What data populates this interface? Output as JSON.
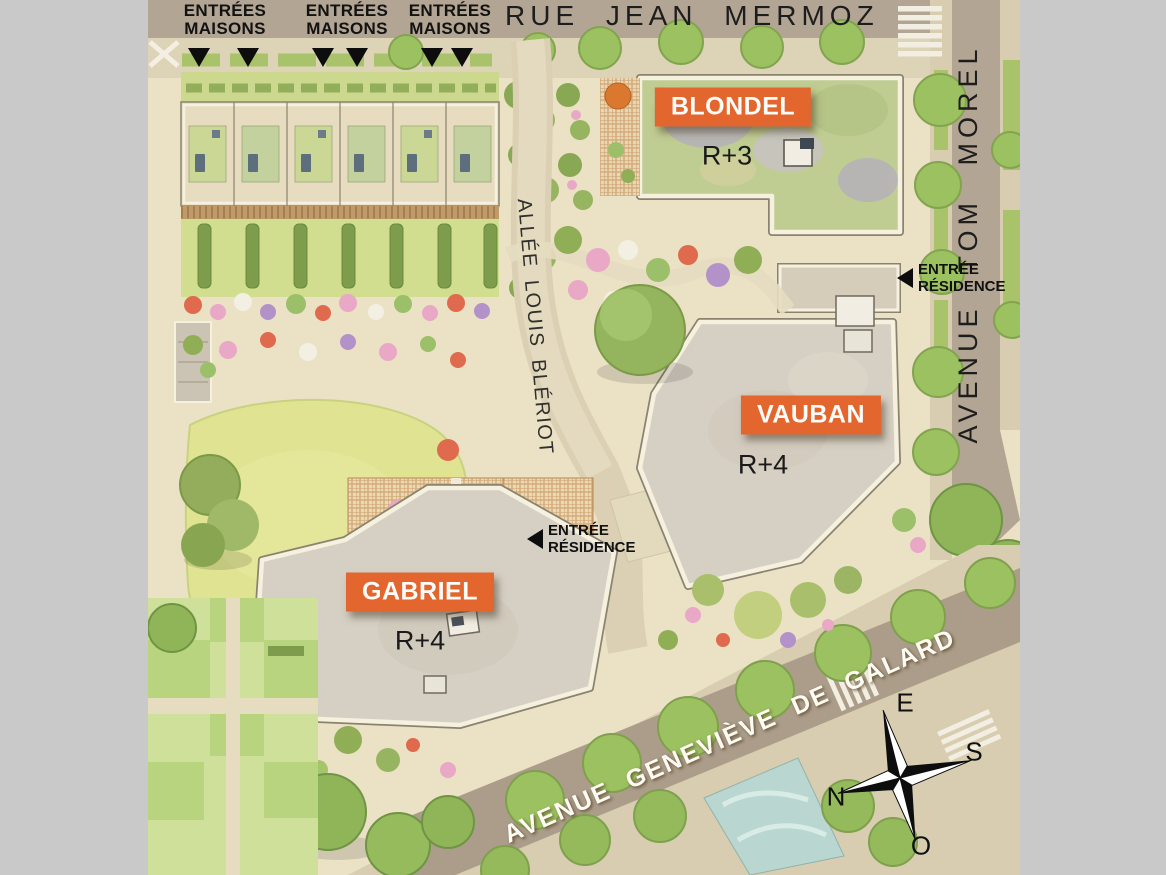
{
  "colors": {
    "accent_orange": "#E2662D",
    "frame_gray": "#C9C9C9",
    "roof_gray": "#D6D0C4",
    "green_roof": "#BFCC92",
    "road": "#B3A593",
    "lawn": "#DFE392"
  },
  "streets": {
    "top": "RUE JEAN MERMOZ",
    "right": "AVENUE TOM MOREL",
    "bottom": "AVENUE GENEVIÈVE DE GALARD",
    "alley": "ALLÉE LOUIS BLÉRIOT"
  },
  "buildings": [
    {
      "name": "BLONDEL",
      "floors": "R+3"
    },
    {
      "name": "VAUBAN",
      "floors": "R+4"
    },
    {
      "name": "GABRIEL",
      "floors": "R+4"
    }
  ],
  "entrances": {
    "maisons": [
      {
        "text": "ENTRÉES\nMAISONS"
      },
      {
        "text": "ENTRÉES\nMAISONS"
      },
      {
        "text": "ENTRÉES\nMAISONS"
      }
    ],
    "residence": [
      {
        "text": "ENTRÉE\nRÉSIDENCE"
      },
      {
        "text": "ENTRÉE\nRÉSIDENCE"
      }
    ]
  },
  "compass": {
    "north": "N",
    "south": "S",
    "east": "E",
    "west": "O"
  }
}
